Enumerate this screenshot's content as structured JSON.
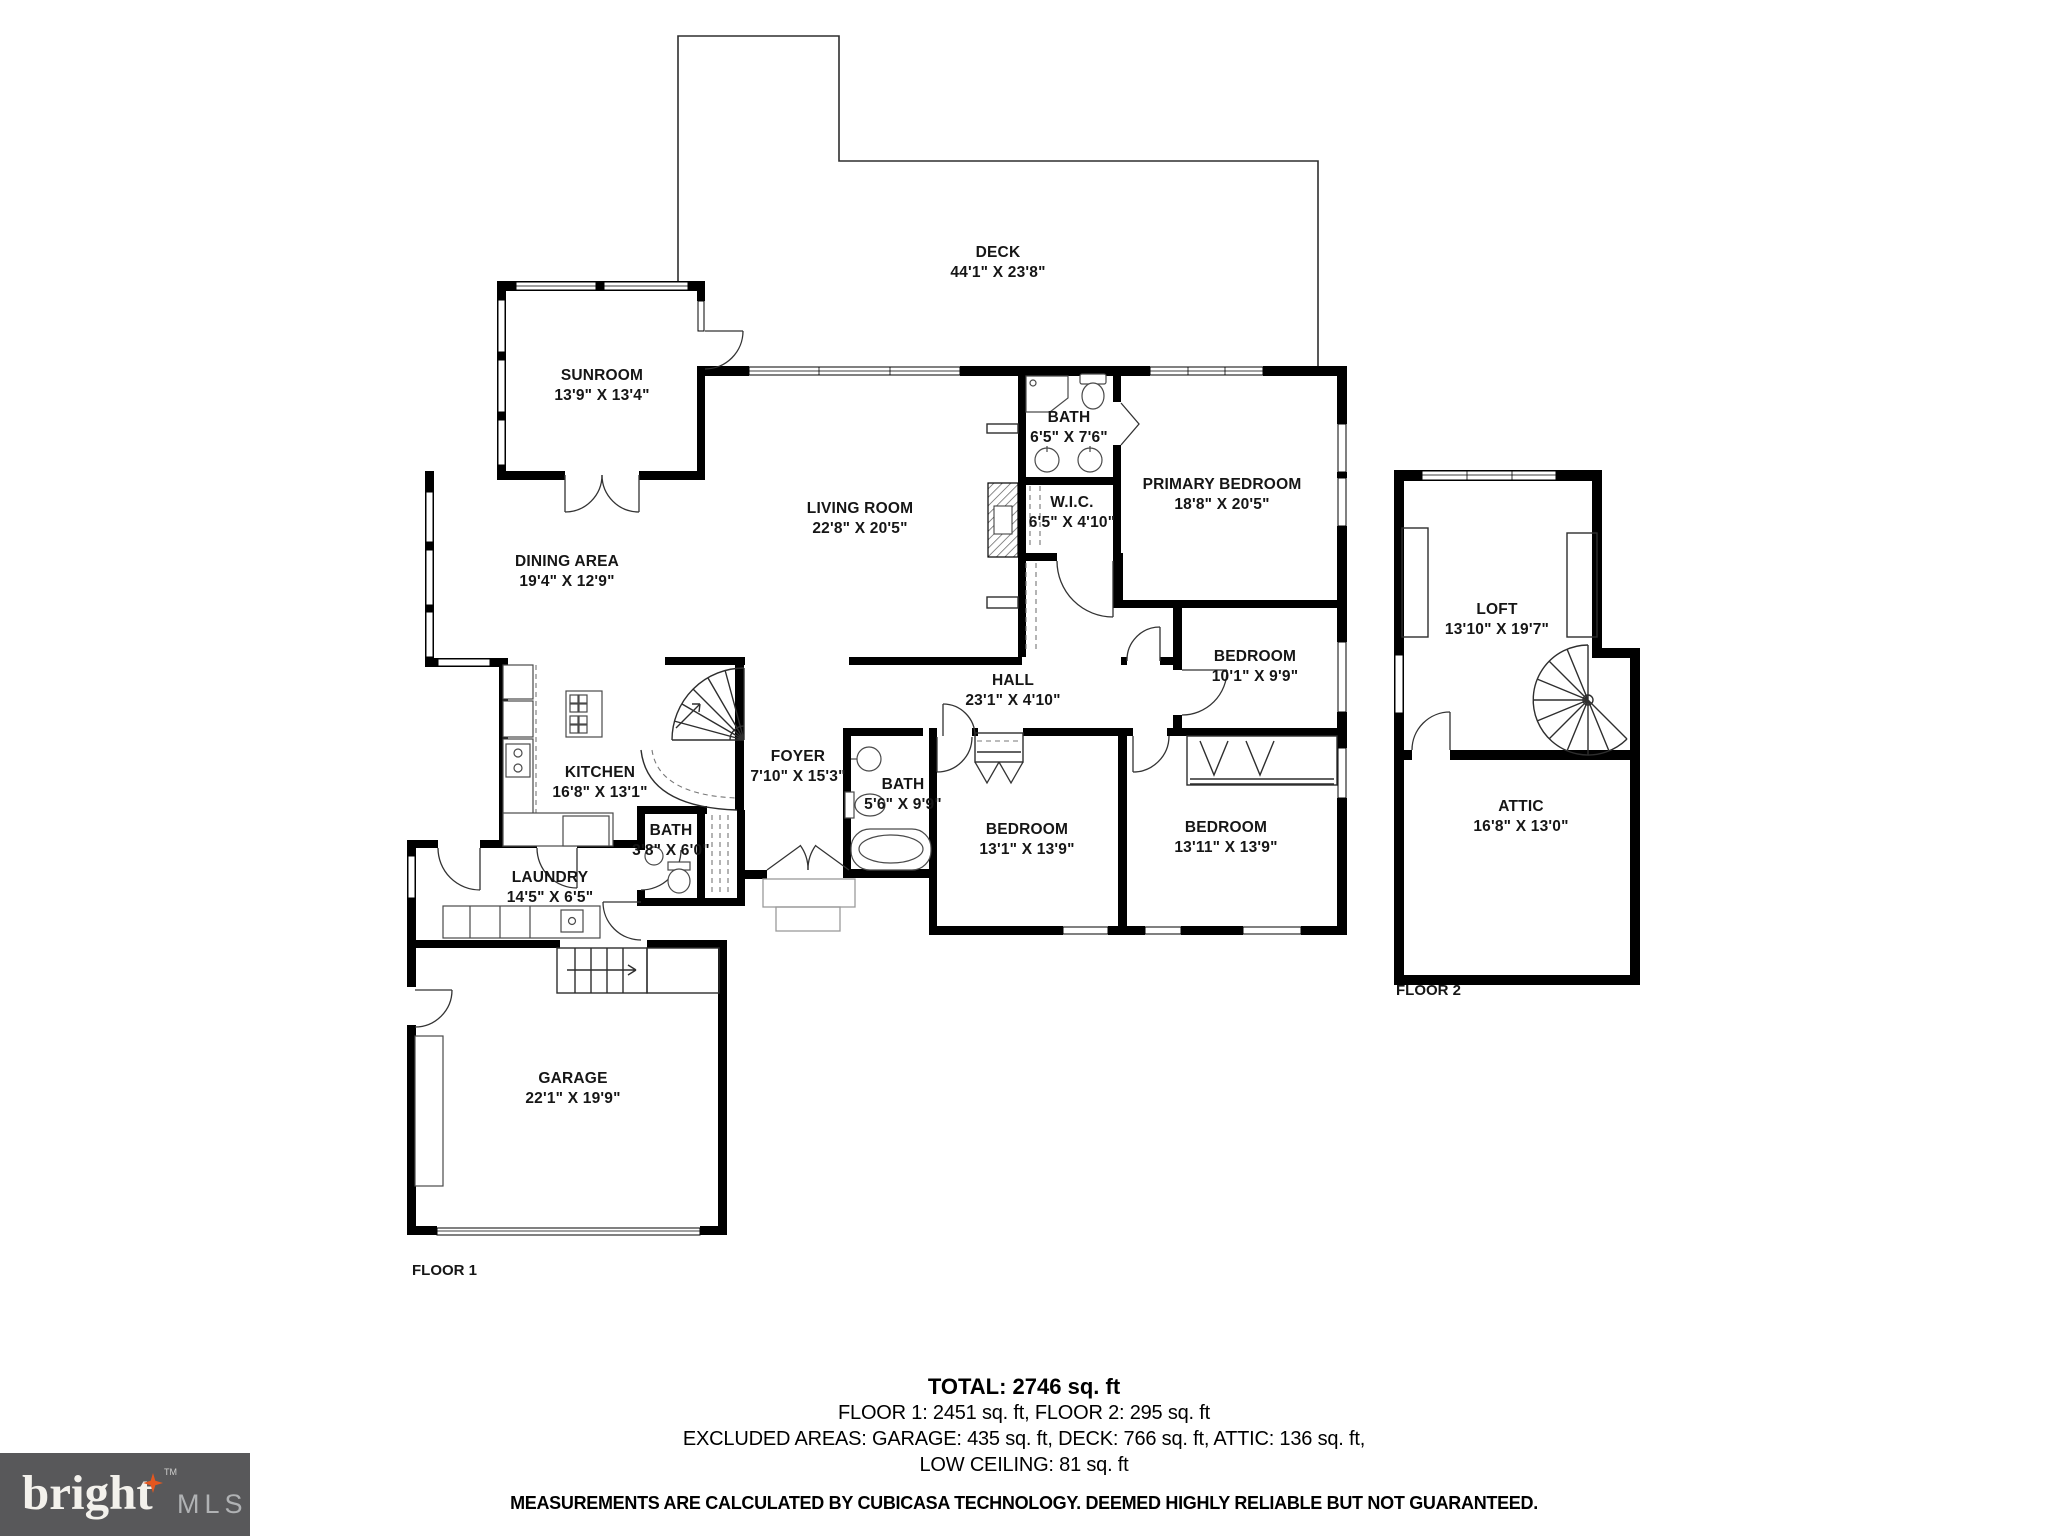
{
  "palette": {
    "wall": "#000000",
    "thin_line": "#2e2e2e",
    "fixture_line": "#4a4a4a",
    "light_line": "#9a9a9a",
    "label_text": "#161616",
    "logo_bg": "#58585a",
    "logo_text": "#f3f1ec",
    "logo_star": "#e4571f",
    "logo_mls": "#b0b2b4"
  },
  "rooms": {
    "deck": {
      "name": "DECK",
      "dims": "44'1\" X 23'8\""
    },
    "sunroom": {
      "name": "SUNROOM",
      "dims": "13'9\" X 13'4\""
    },
    "living_room": {
      "name": "LIVING ROOM",
      "dims": "22'8\" X 20'5\""
    },
    "dining_area": {
      "name": "DINING AREA",
      "dims": "19'4\" X 12'9\""
    },
    "bath_primary": {
      "name": "BATH",
      "dims": "6'5\" X 7'6\""
    },
    "wic": {
      "name": "W.I.C.",
      "dims": "6'5\" X 4'10\""
    },
    "primary_bedroom": {
      "name": "PRIMARY BEDROOM",
      "dims": "18'8\" X 20'5\""
    },
    "bedroom_small": {
      "name": "BEDROOM",
      "dims": "10'1\" X 9'9\""
    },
    "hall": {
      "name": "HALL",
      "dims": "23'1\" X 4'10\""
    },
    "kitchen": {
      "name": "KITCHEN",
      "dims": "16'8\" X 13'1\""
    },
    "foyer": {
      "name": "FOYER",
      "dims": "7'10\" X 15'3\""
    },
    "bath_hall": {
      "name": "BATH",
      "dims": "5'6\" X 9'9\""
    },
    "bath_powder": {
      "name": "BATH",
      "dims": "3'8\" X 6'0\""
    },
    "laundry": {
      "name": "LAUNDRY",
      "dims": "14'5\" X 6'5\""
    },
    "bedroom_mid": {
      "name": "BEDROOM",
      "dims": "13'1\" X 13'9\""
    },
    "bedroom_right": {
      "name": "BEDROOM",
      "dims": "13'11\" X 13'9\""
    },
    "garage": {
      "name": "GARAGE",
      "dims": "22'1\" X 19'9\""
    },
    "loft": {
      "name": "LOFT",
      "dims": "13'10\" X 19'7\""
    },
    "attic": {
      "name": "ATTIC",
      "dims": "16'8\" X 13'0\""
    }
  },
  "floor_labels": {
    "floor1": "FLOOR 1",
    "floor2": "FLOOR 2"
  },
  "summary": {
    "total": "TOTAL: 2746 sq. ft",
    "floors": "FLOOR 1: 2451 sq. ft, FLOOR 2: 295 sq. ft",
    "excluded": "EXCLUDED AREAS: GARAGE: 435 sq. ft, DECK: 766 sq. ft, ATTIC: 136 sq. ft,",
    "low_ceiling": "LOW CEILING: 81 sq. ft",
    "disclaimer": "MEASUREMENTS ARE CALCULATED BY CUBICASA TECHNOLOGY. DEEMED HIGHLY RELIABLE BUT NOT GUARANTEED."
  },
  "logo": {
    "brand": "bright",
    "tm": "TM",
    "suffix": "MLS"
  }
}
